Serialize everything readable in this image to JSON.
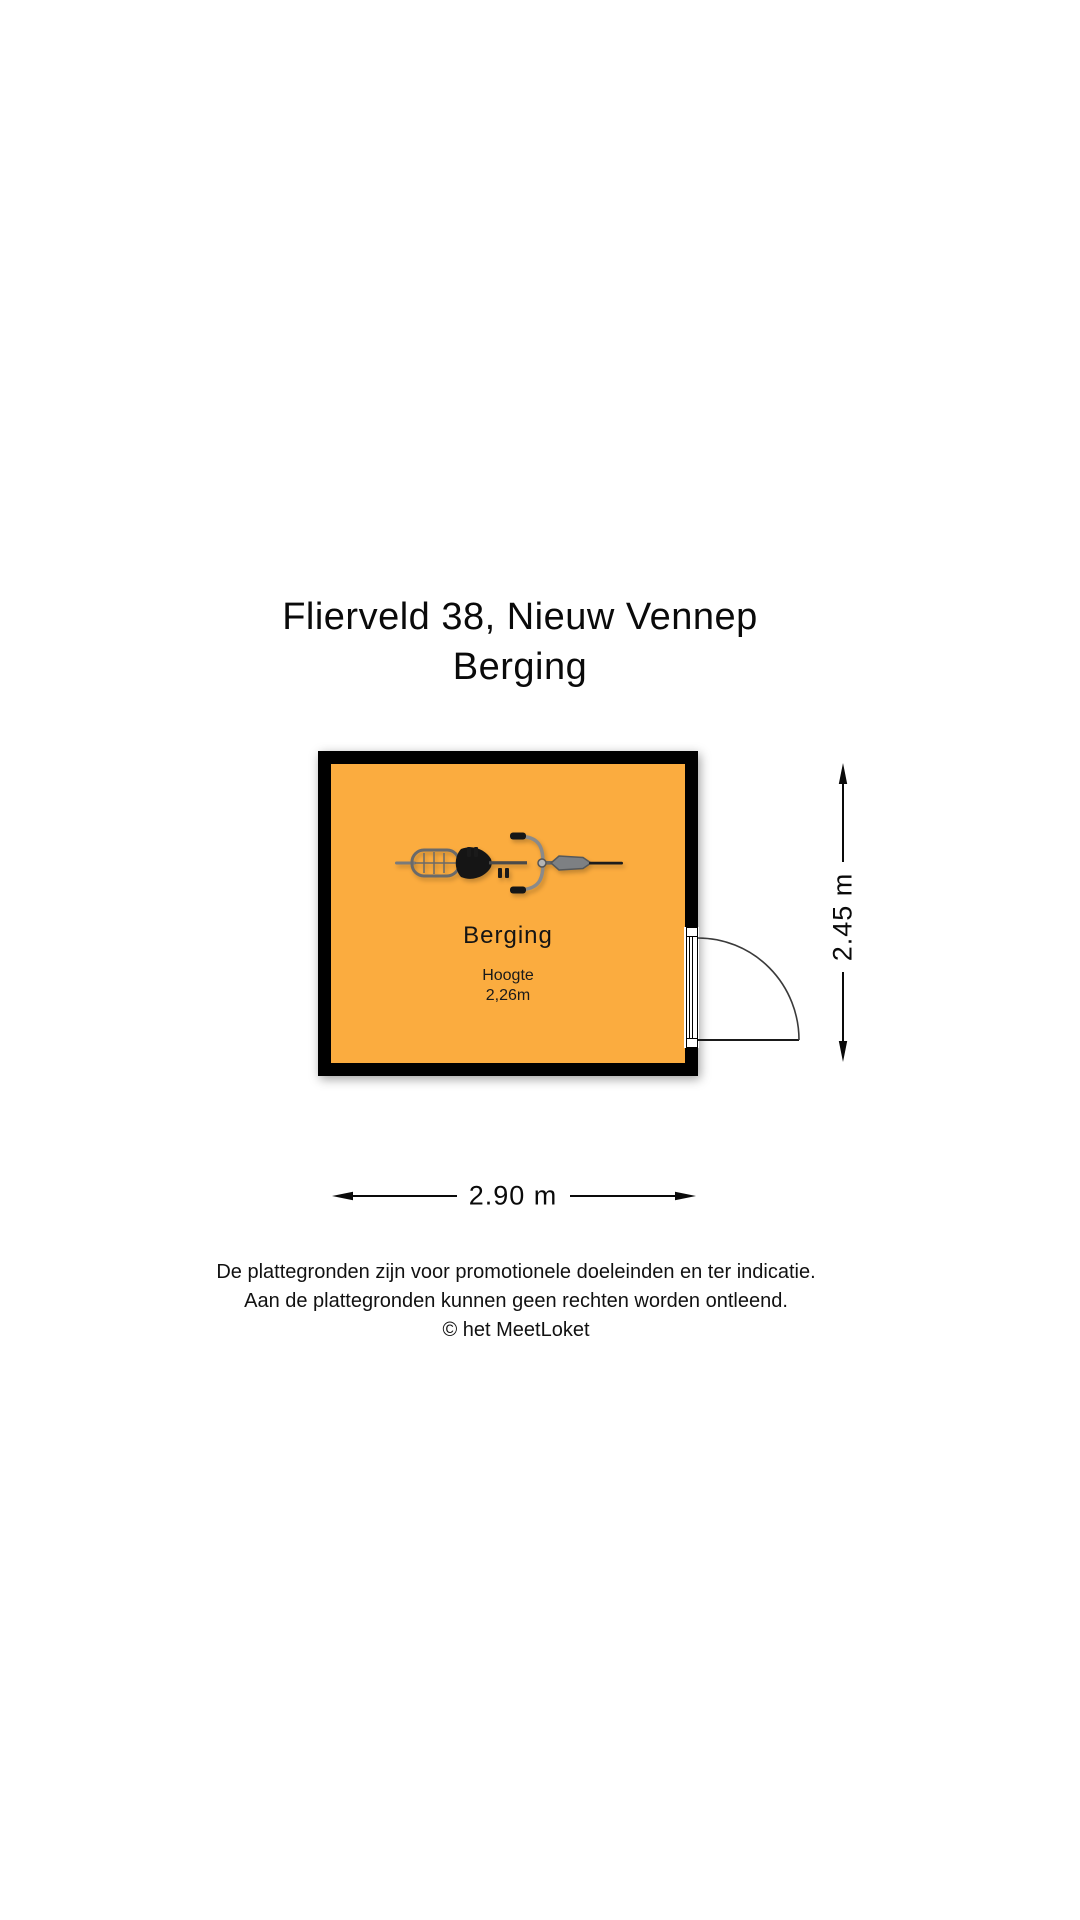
{
  "title": {
    "address": "Flierveld 38, Nieuw Vennep",
    "room_type": "Berging"
  },
  "floorplan": {
    "room": {
      "name": "Berging",
      "height_label": "Hoogte",
      "height_value": "2,26m",
      "floor_color": "#FBAC3F",
      "wall_color": "#000000",
      "icon": "bicycle-top-view"
    },
    "dimensions": {
      "width_label": "2.90 m",
      "height_label": "2.45 m"
    },
    "door": {
      "symbol": "door-swing",
      "wall": "right"
    }
  },
  "disclaimer": {
    "line1": "De plattegronden zijn voor promotionele doeleinden en ter indicatie.",
    "line2": "Aan de plattegronden kunnen geen rechten worden ontleend.",
    "line3": "© het MeetLoket"
  }
}
